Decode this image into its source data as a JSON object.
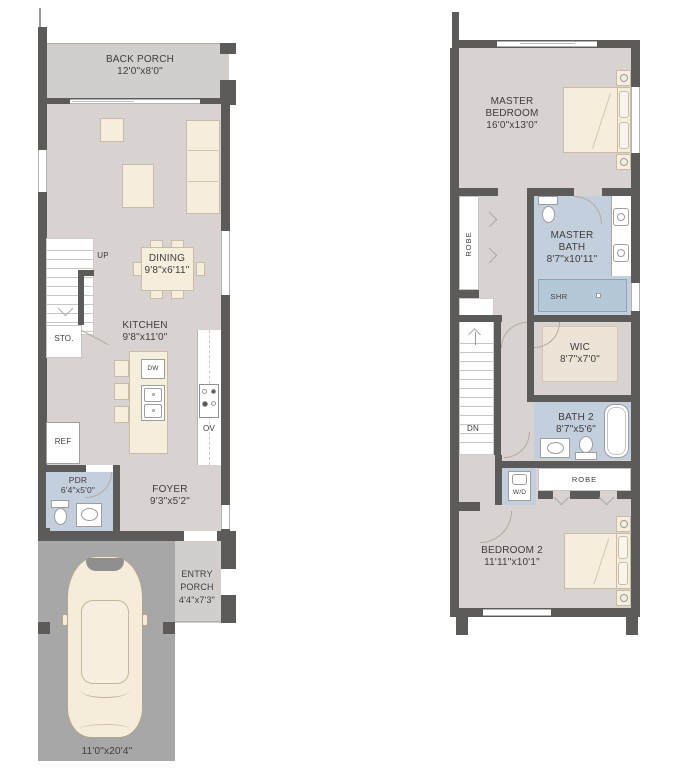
{
  "floor1": {
    "back_porch": {
      "name": "BACK PORCH",
      "dims": "12'0\"x8'0\""
    },
    "dining": {
      "name": "DINING",
      "dims": "9'8\"x6'11\""
    },
    "kitchen": {
      "name": "KITCHEN",
      "dims": "9'8\"x11'0\""
    },
    "pdr": {
      "name": "PDR",
      "dims": "6'4\"x5'0\""
    },
    "foyer": {
      "name": "FOYER",
      "dims": "9'3\"x5'2\""
    },
    "entry_porch": {
      "name": "ENTRY PORCH",
      "dims": "4'4\"x7'3\""
    },
    "driveway": {
      "dims": "11'0\"x20'4\""
    },
    "up": "UP",
    "sto": "STO.",
    "ref": "REF",
    "dw": "DW",
    "ov": "OV"
  },
  "floor2": {
    "master_bedroom": {
      "name": "MASTER BEDROOM",
      "dims": "16'0\"x13'0\""
    },
    "master_bath": {
      "name": "MASTER BATH",
      "dims": "8'7\"x10'11\""
    },
    "wic": {
      "name": "WIC",
      "dims": "8'7\"x7'0\""
    },
    "bath2": {
      "name": "BATH 2",
      "dims": "8'7\"x5'6\""
    },
    "bedroom2": {
      "name": "BEDROOM 2",
      "dims": "11'11\"x10'1\""
    },
    "robe_side": "ROBE",
    "robe_rear": "ROBE",
    "shr": "SHR",
    "wd": "W/D",
    "dn": "DN"
  },
  "colors": {
    "wall": "#5d5a5a",
    "floor": "#d8d3d0",
    "bath_floor": "#c3cfdc",
    "shower": "#b5c8d8",
    "driveway": "#a7a7a7",
    "furniture": "#f5eedd",
    "text": "#3e3c3d"
  }
}
